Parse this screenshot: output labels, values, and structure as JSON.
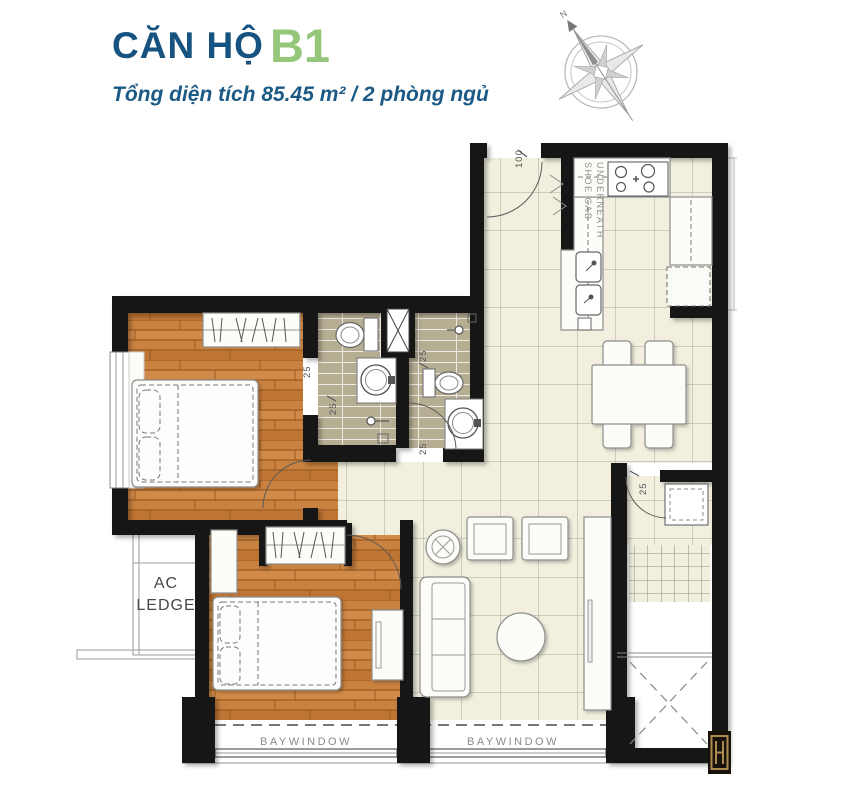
{
  "header": {
    "title_prefix": "CĂN HỘ",
    "title_unit": "B1",
    "subtitle": "Tổng diện tích 85.45 m²  /  2 phòng ngủ"
  },
  "labels": {
    "ac_line1": "AC",
    "ac_line2": "LEDGE",
    "baywindow": "BAYWINDOW",
    "shoe_cab_line1": "SHOE CAB",
    "shoe_cab_line2": "UNDERNEATH",
    "dim_100": "100",
    "dim_25": "25",
    "compass_n": "N"
  },
  "colors": {
    "title_navy": "#175380",
    "unit_green": "#94c779",
    "wall_black": "#121212",
    "tile_floor": "#f2efde",
    "tile_line": "#a9a89b",
    "wood_floor": "#c9823f",
    "wood_line": "#9a5c22",
    "bath_floor": "#b6ae93",
    "bath_line": "#ffffff",
    "label_gray": "#8a8a8a",
    "logo_gold": "#a78a4e"
  }
}
